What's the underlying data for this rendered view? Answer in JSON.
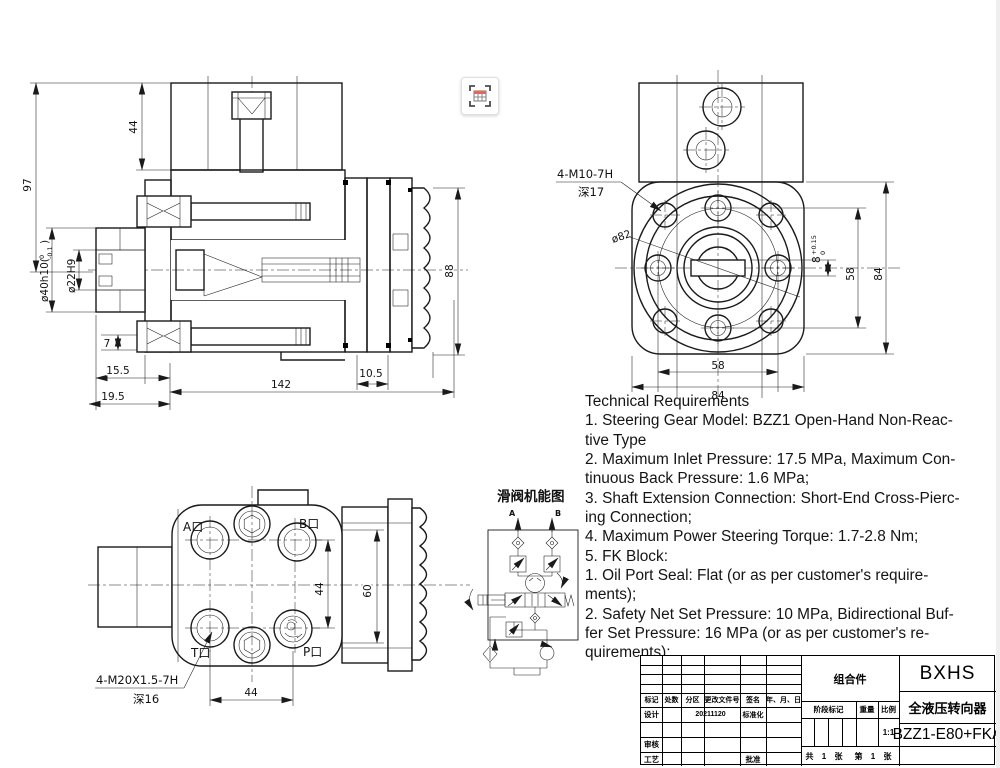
{
  "page": {
    "background": "#ffffff",
    "line_color": "#1a1a1a"
  },
  "capture_icon": {
    "name": "table-capture",
    "accent": "#e0685c"
  },
  "sec": {
    "d97": "97",
    "d44": "44",
    "d7": "7",
    "d15_5": "15.5",
    "d19_5": "19.5",
    "d142": "142",
    "d10_5": "10.5",
    "d88": "88",
    "shaft": {
      "main": "ø40h10(",
      "hi": "0",
      "lo": "-0.1",
      "close": ")"
    },
    "bore": "ø22H9"
  },
  "front": {
    "note": "4-M10-7H",
    "depth": "深17",
    "pitch": "ø82",
    "slot": {
      "nom": "8",
      "hi": "+0.15",
      "lo": "0"
    },
    "d58v": "58",
    "d84v": "84",
    "d58h": "58",
    "d84h": "84"
  },
  "ports": {
    "a": "A口",
    "b": "B口",
    "t": "T口",
    "p": "P口",
    "note": "4-M20X1.5-7H",
    "depth": "深16",
    "d44v": "44",
    "d60": "60",
    "d44h": "44"
  },
  "schem": {
    "title": "滑阀机能图",
    "a": "A",
    "b": "B"
  },
  "tech": {
    "title": "Technical Requirements",
    "body": "1. Steering Gear Model: BZZ1 Open-Hand Non-Reac-\ntive Type\n2. Maximum Inlet Pressure: 17.5 MPa, Maximum Con-\ntinuous Back Pressure: 1.6 MPa;\n3. Shaft Extension Connection: Short-End Cross-Pierc-\ning Connection;\n4. Maximum Power Steering Torque: 1.7-2.8 Nm;\n5. FK Block:\n1. Oil Port Seal: Flat (or as per customer's require-\nments);\n2. Safety Net Set Pressure: 10 MPa, Bidirectional Buf-\nfer Set Pressure: 16 MPa (or as per customer's re-\nquirements);"
  },
  "tb": {
    "part_type": "组合件",
    "company": "BXHS",
    "product_name": "全液压转向器",
    "model": "BZZ1-E80+FKA",
    "h_mark": "标记",
    "h_count": "处数",
    "h_zone": "分区",
    "h_doc": "更改文件号",
    "h_sign": "签名",
    "h_date": "年、月、日",
    "design": "设计",
    "design_date": "20211120",
    "standardization": "标准化",
    "review": "审核",
    "process": "工艺",
    "approve": "批准",
    "stage_label": "阶段标记",
    "weight": "重量",
    "scale": "比例",
    "scale_value": "1:1",
    "sheet_total": "共 1 张",
    "sheet_page": "第 1 张"
  }
}
